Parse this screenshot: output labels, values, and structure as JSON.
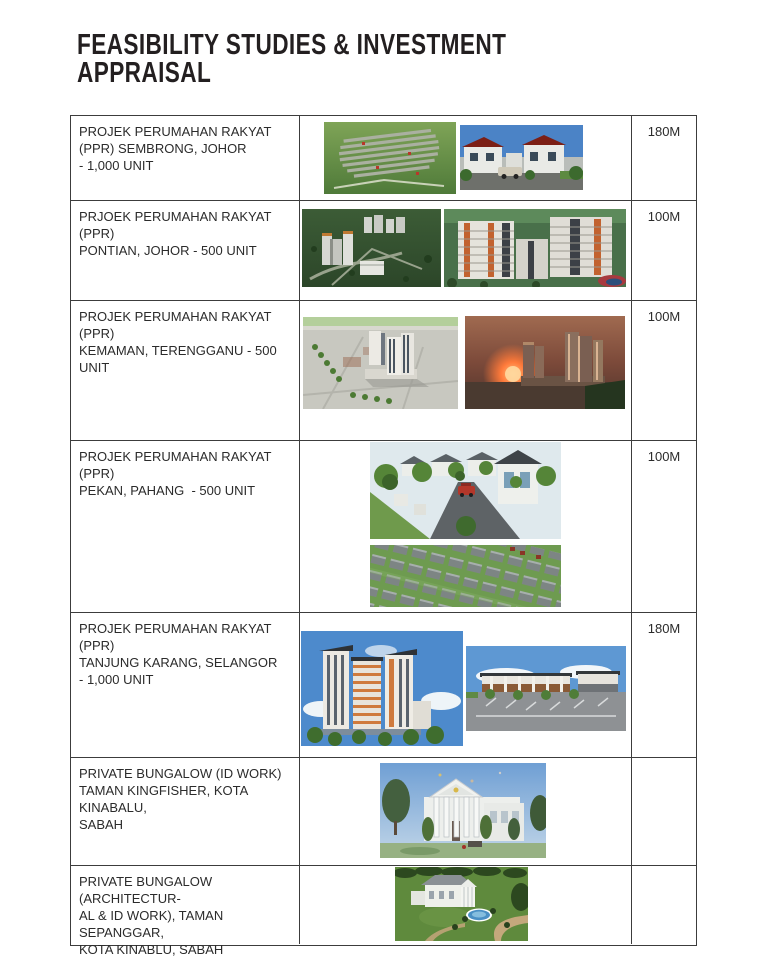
{
  "page": {
    "title_line1": "FEASIBILITY STUDIES & INVESTMENT",
    "title_line2": "APPRAISAL",
    "title_color": "#231f20"
  },
  "table": {
    "rows": [
      {
        "lines": [
          "PROJEK PERUMAHAN RAKYAT",
          "(PPR) SEMBRONG, JOHOR",
          "- 1,000 UNIT"
        ],
        "value": "180M",
        "images": [
          {
            "alt": "aerial view of PPR Sembrong housing estate with rows of houses in green fields"
          },
          {
            "alt": "street rendering of white terrace houses with dark red roofs under blue sky"
          }
        ]
      },
      {
        "lines": [
          "PRJOEK PERUMAHAN RAKYAT (PPR)",
          "PONTIAN, JOHOR - 500 UNIT"
        ],
        "value": "100M",
        "images": [
          {
            "alt": "aerial rendering of PPR Pontian tower blocks in green landscape"
          },
          {
            "alt": "close aerial rendering of apartment slab blocks with orange accents"
          }
        ]
      },
      {
        "lines": [
          "PROJEK PERUMAHAN RAKYAT (PPR)",
          "KEMAMAN, TERENGGANU - 500 UNIT"
        ],
        "value": "100M",
        "images": [
          {
            "alt": "daytime aerial rendering of PPR Kemaman towers with tree-lined roads"
          },
          {
            "alt": "sunset rendering of PPR Kemaman towers with orange glow"
          }
        ]
      },
      {
        "lines": [
          "PROJEK PERUMAHAN RAKYAT (PPR)",
          "PEKAN, PAHANG  - 500 UNIT"
        ],
        "value": "100M",
        "images": [
          {
            "alt": "street-level rendering of landed houses with trees and red car"
          },
          {
            "alt": "aerial rendering of rows of terrace houses with grey roofs"
          }
        ]
      },
      {
        "lines": [
          "PROJEK PERUMAHAN RAKYAT (PPR)",
          "TANJUNG KARANG, SELANGOR",
          "- 1,000 UNIT"
        ],
        "value": "180M",
        "images": [
          {
            "alt": "rendering of high-rise apartment towers with orange and white facade"
          },
          {
            "alt": "rendering of low-rise shop buildings with parking lot"
          }
        ]
      },
      {
        "lines": [
          "PRIVATE BUNGALOW (ID WORK)",
          "TAMAN KINGFISHER, KOTA KINABALU,",
          "SABAH"
        ],
        "value": "",
        "images": [
          {
            "alt": "rendering of white colonial bungalow with columns and trees"
          }
        ]
      },
      {
        "lines": [
          "PRIVATE BUNGALOW (ARCHITECTUR-",
          "AL & ID WORK), TAMAN SEPANGGAR,",
          "KOTA KINABLU, SABAH"
        ],
        "value": "",
        "images": [
          {
            "alt": "aerial rendering of white bungalow with oval swimming pool and gardens"
          }
        ]
      }
    ]
  }
}
